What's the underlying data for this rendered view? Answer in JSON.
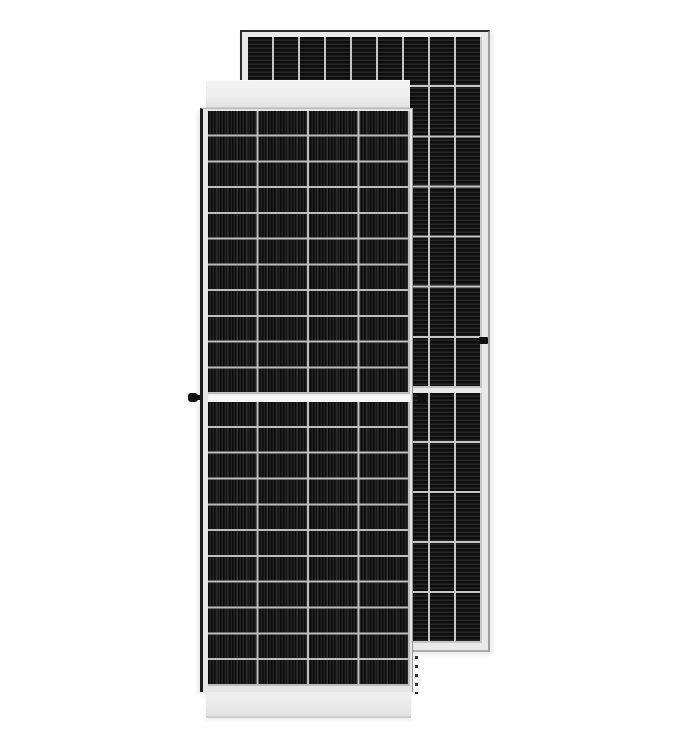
{
  "scene": {
    "type": "product-photo",
    "subject": "Two framed monocrystalline solar panels standing upright, front view panel in front and back view panel behind",
    "background_color": "#ffffff"
  },
  "front_panel": {
    "view": "front",
    "stripe_direction": "vertical",
    "columns": 4,
    "rows_top_half": 11,
    "rows_bottom_half": 11,
    "has_center_gap": true,
    "colors": {
      "frame": "#e5e5e5",
      "frame_edge_dark": "#1c1c1c",
      "top_band": "#efefef",
      "bottom_band": "#eaeaea",
      "cell_dark": "#0b0b0b",
      "cell_light": "#232323",
      "grid_line": "#bdbdbd",
      "center_gap": "#f7f7f7"
    }
  },
  "rear_panel": {
    "view": "back",
    "stripe_direction": "horizontal",
    "columns": 9,
    "rows_top_half": 7,
    "rows_bottom_half": 5,
    "has_center_gap": true,
    "colors": {
      "frame": "#e9e9e9",
      "frame_edge_dark": "#2c2c2c",
      "cell_dark": "#0d0d0d",
      "cell_light": "#272727",
      "grid_line": "#c6c6c6",
      "center_gap": "#e8e8e8"
    }
  },
  "details": {
    "grounding_knob_color": "#111111",
    "side_clip_color": "#111111",
    "dash_marks_color": "#2e2e2e"
  }
}
